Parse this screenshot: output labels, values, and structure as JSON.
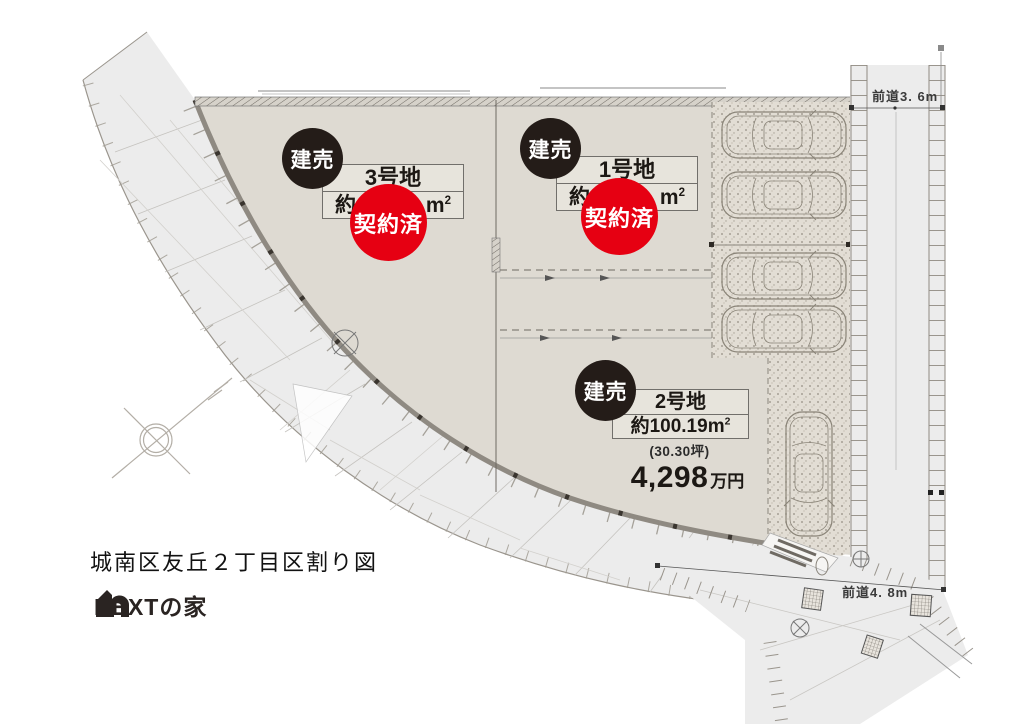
{
  "title": "城南区友丘２丁目区割り図",
  "logo_text": "NEXTの家",
  "badge_for_sale": "建売",
  "badge_sold": "契約済",
  "lots": {
    "lot1": {
      "name": "1号地",
      "area_prefix": "約",
      "area_unit": "m",
      "area_sup": "2",
      "status": "契約済"
    },
    "lot2": {
      "name": "2号地",
      "area_prefix": "約",
      "area_value": "100.19",
      "area_unit": "m",
      "area_sup": "2",
      "tsubo": "(30.30坪)",
      "price_value": "4,298",
      "price_unit": "万円",
      "status": "建売"
    },
    "lot3": {
      "name": "3号地",
      "area_prefix": "約",
      "area_unit": "m",
      "area_sup": "2",
      "status": "契約済"
    }
  },
  "road_labels": {
    "right": "前道3. 6m",
    "bottom": "前道4. 8m"
  },
  "colors": {
    "lot_fill": "#dedad2",
    "road_fill": "#ececec",
    "badge_black": "#241c18",
    "badge_red": "#e60012"
  }
}
